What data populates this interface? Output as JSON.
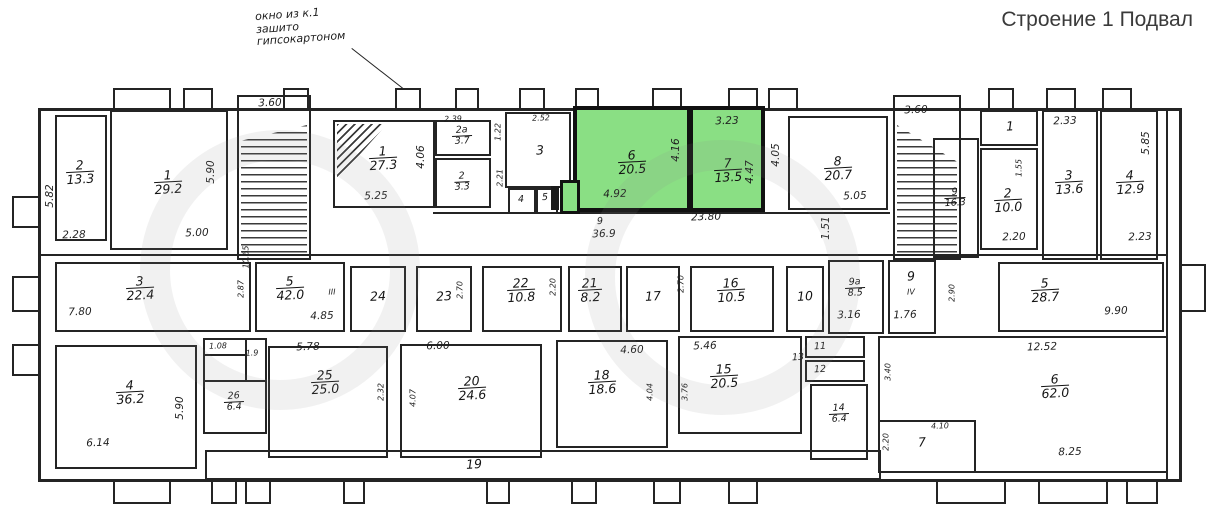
{
  "title": "Строение 1 Подвал",
  "annotation": {
    "line1": "окно из к.1",
    "line2": "зашито",
    "line3": "гипсокартоном"
  },
  "colors": {
    "highlight": "#8adf84",
    "ink": "#242424"
  },
  "rooms": [
    {
      "n": "2",
      "a": "13.3"
    },
    {
      "n": "1",
      "a": "29.2"
    },
    {
      "n": "1",
      "a": "27.3"
    },
    {
      "n": "2а",
      "a": "3.7"
    },
    {
      "n": "2",
      "a": "3.3"
    },
    {
      "n": "3"
    },
    {
      "n": "4"
    },
    {
      "n": "5"
    },
    {
      "n": "6",
      "a": "20.5"
    },
    {
      "n": "7",
      "a": "13.5"
    },
    {
      "n": "8",
      "a": "20.7"
    },
    {
      "n": "9",
      "a": "16.3"
    },
    {
      "n": "1"
    },
    {
      "n": "2",
      "a": "10.0"
    },
    {
      "n": "3",
      "a": "13.6"
    },
    {
      "n": "4",
      "a": "12.9"
    },
    {
      "n": "3",
      "a": "22.4"
    },
    {
      "n": "5",
      "a": "42.0"
    },
    {
      "n": "24"
    },
    {
      "n": "23"
    },
    {
      "n": "22",
      "a": "10.8"
    },
    {
      "n": "21",
      "a": "8.2"
    },
    {
      "n": "17"
    },
    {
      "n": "16",
      "a": "10.5"
    },
    {
      "n": "10"
    },
    {
      "n": "9а",
      "a": "8.5"
    },
    {
      "n": "9"
    },
    {
      "n": "5",
      "a": "28.7"
    },
    {
      "n": "4",
      "a": "36.2"
    },
    {
      "n": "26",
      "a": "6.4"
    },
    {
      "n": "25",
      "a": "25.0"
    },
    {
      "n": "20",
      "a": "24.6"
    },
    {
      "n": "18",
      "a": "18.6"
    },
    {
      "n": "15",
      "a": "20.5"
    },
    {
      "n": "14",
      "a": "6.4"
    },
    {
      "n": "6",
      "a": "62.0"
    },
    {
      "n": "7"
    },
    {
      "n": "19"
    },
    {
      "n": "9"
    },
    {
      "n": "11"
    },
    {
      "n": "12"
    },
    {
      "n": "13"
    }
  ],
  "dims": [
    "3.60",
    "3.60",
    "5.82",
    "2.28",
    "5.00",
    "5.90",
    "5.25",
    "4.06",
    "2.39",
    "1.22",
    "2.21",
    "2.52",
    "3.23",
    "4.16",
    "4.92",
    "4.47",
    "23.80",
    "36.9",
    "5.05",
    "4.05",
    "1.51",
    "2.33",
    "1.55",
    "2.20",
    "5.85",
    "2.23",
    "10.65",
    "7.80",
    "2.87",
    "4.85",
    "III",
    "2.70",
    "2.20",
    "2.70",
    "3.16",
    "IV",
    "1.76",
    "2.90",
    "9.90",
    "5.90",
    "6.14",
    "1.08",
    "1.9",
    "5.78",
    "2.32",
    "6.00",
    "4.07",
    "4.60",
    "4.04",
    "5.46",
    "3.76",
    "3.40",
    "2.20",
    "12.52",
    "8.25",
    "4.10"
  ]
}
